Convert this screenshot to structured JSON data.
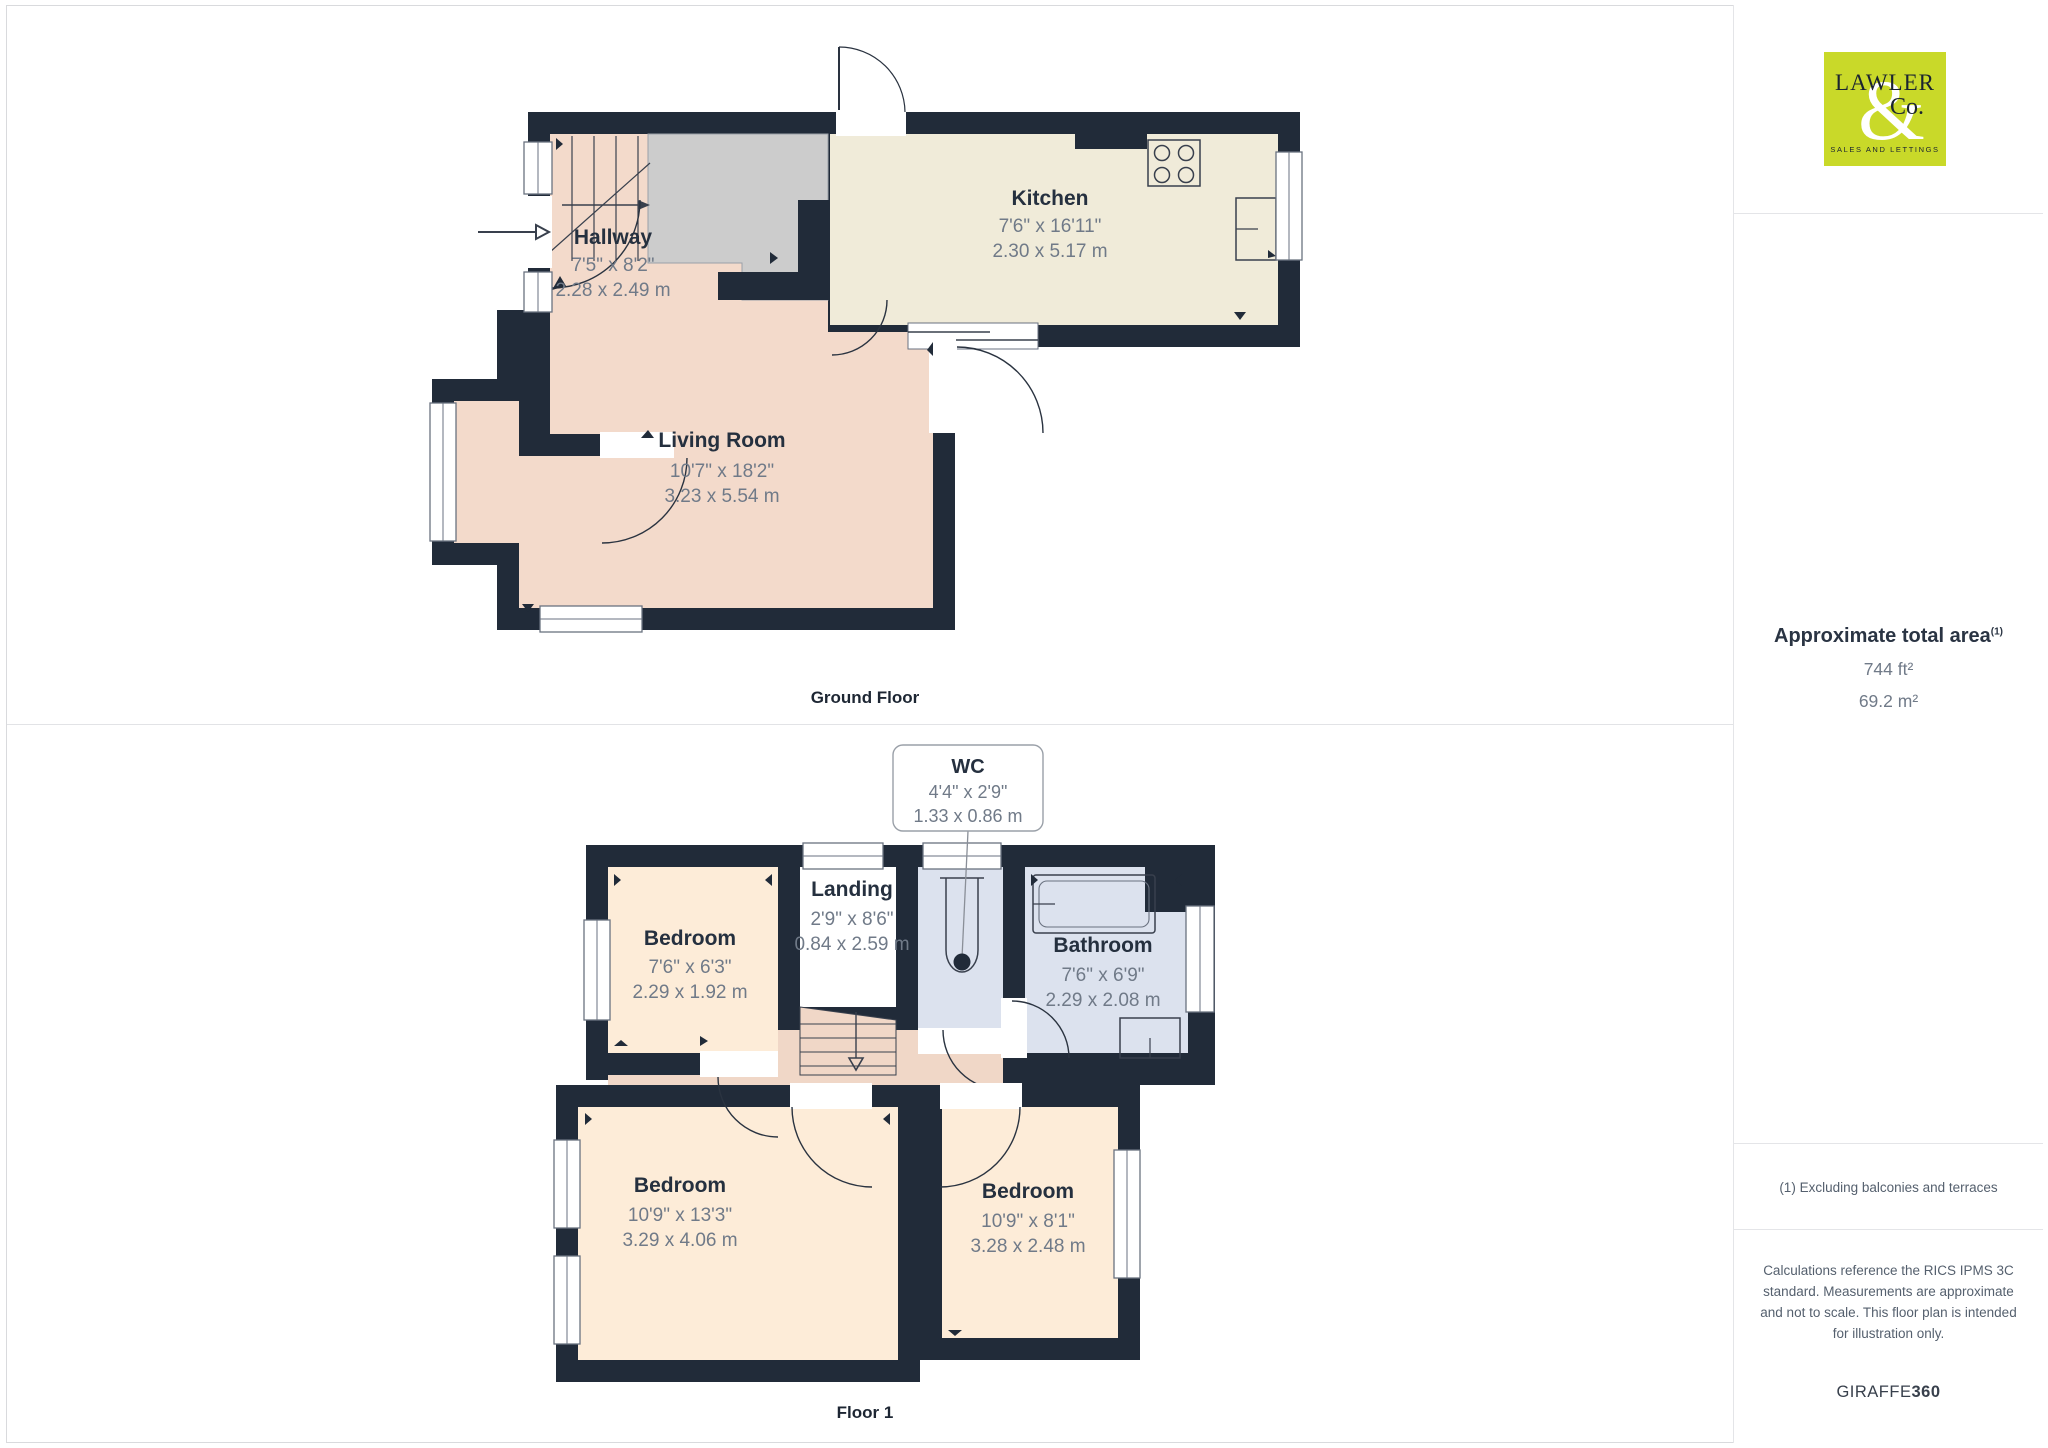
{
  "ground_floor": {
    "label": "Ground Floor",
    "rooms": {
      "hallway": {
        "name": "Hallway",
        "imperial": "7'5\" x 8'2\"",
        "metric": "2.28 x 2.49 m"
      },
      "kitchen": {
        "name": "Kitchen",
        "imperial": "7'6\" x 16'11\"",
        "metric": "2.30 x 5.17 m"
      },
      "living_room": {
        "name": "Living Room",
        "imperial": "10'7\" x 18'2\"",
        "metric": "3.23 x 5.54 m"
      }
    }
  },
  "floor_1": {
    "label": "Floor 1",
    "rooms": {
      "wc": {
        "name": "WC",
        "imperial": "4'4\" x 2'9\"",
        "metric": "1.33 x 0.86 m"
      },
      "landing": {
        "name": "Landing",
        "imperial": "2'9\" x 8'6\"",
        "metric": "0.84 x 2.59 m"
      },
      "bedroom_1": {
        "name": "Bedroom",
        "imperial": "7'6\" x 6'3\"",
        "metric": "2.29 x 1.92 m"
      },
      "bathroom": {
        "name": "Bathroom",
        "imperial": "7'6\" x 6'9\"",
        "metric": "2.29 x 2.08 m"
      },
      "bedroom_2": {
        "name": "Bedroom",
        "imperial": "10'9\" x 13'3\"",
        "metric": "3.29 x 4.06 m"
      },
      "bedroom_3": {
        "name": "Bedroom",
        "imperial": "10'9\" x 8'1\"",
        "metric": "3.28 x 2.48 m"
      }
    }
  },
  "sidebar": {
    "logo": {
      "word1": "LAWLER",
      "amp": "&",
      "word2": "Co.",
      "tagline": "SALES AND LETTINGS"
    },
    "area": {
      "title": "Approximate total area",
      "superscript": "(1)",
      "imperial": "744 ft²",
      "metric": "69.2 m²"
    },
    "footnote": "(1) Excluding balconies and terraces",
    "disclaimer": "Calculations reference the RICS IPMS 3C standard. Measurements are approximate and not to scale. This floor plan is intended for illustration only.",
    "brand": {
      "name": "GIRAFFE",
      "suffix": "360"
    }
  },
  "colors": {
    "wall": "#212b39",
    "room_pink": "#f3dacb",
    "room_cream": "#f0ebd9",
    "room_peach": "#fdecd8",
    "room_blue": "#dce2ee",
    "corridor": "#f0d7c7",
    "stairs_gray": "#cccccc",
    "logo_green": "#c9d929"
  }
}
